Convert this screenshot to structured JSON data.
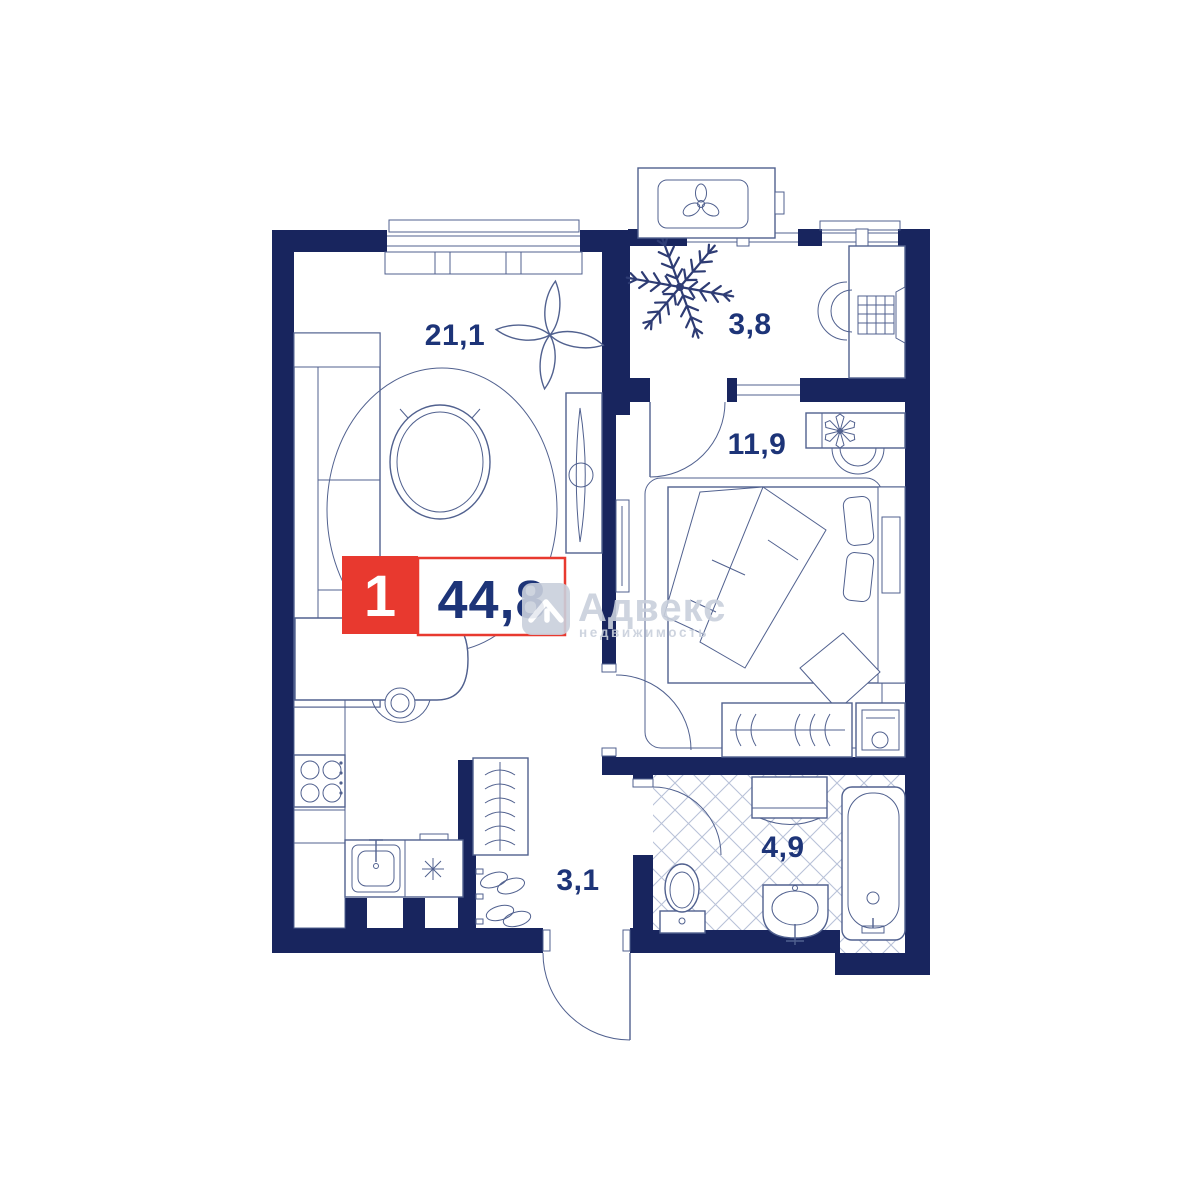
{
  "floorplan": {
    "badge": {
      "rooms_count": "1",
      "total_area": "44,8"
    },
    "rooms": [
      {
        "name": "living-kitchen",
        "area_label": "21,1"
      },
      {
        "name": "loggia",
        "area_label": "3,8"
      },
      {
        "name": "bedroom",
        "area_label": "11,9"
      },
      {
        "name": "hallway",
        "area_label": "3,1"
      },
      {
        "name": "bathroom",
        "area_label": "4,9"
      }
    ],
    "watermark": {
      "brand": "Адвекс",
      "subtitle": "недвижимость"
    },
    "icons": [
      "ac-fan-icon",
      "plant-icon",
      "fern-icon",
      "hanger-icon",
      "flower-icon",
      "house-logo-icon"
    ],
    "colors": {
      "wall": "#18255e",
      "red": "#e8392f",
      "label": "#1d3478",
      "furn": "#51618f",
      "tile": "#b9c2d8",
      "wm": "#c9d0dc",
      "wood": "#3f4f82",
      "plant": "#2e3c74"
    }
  }
}
